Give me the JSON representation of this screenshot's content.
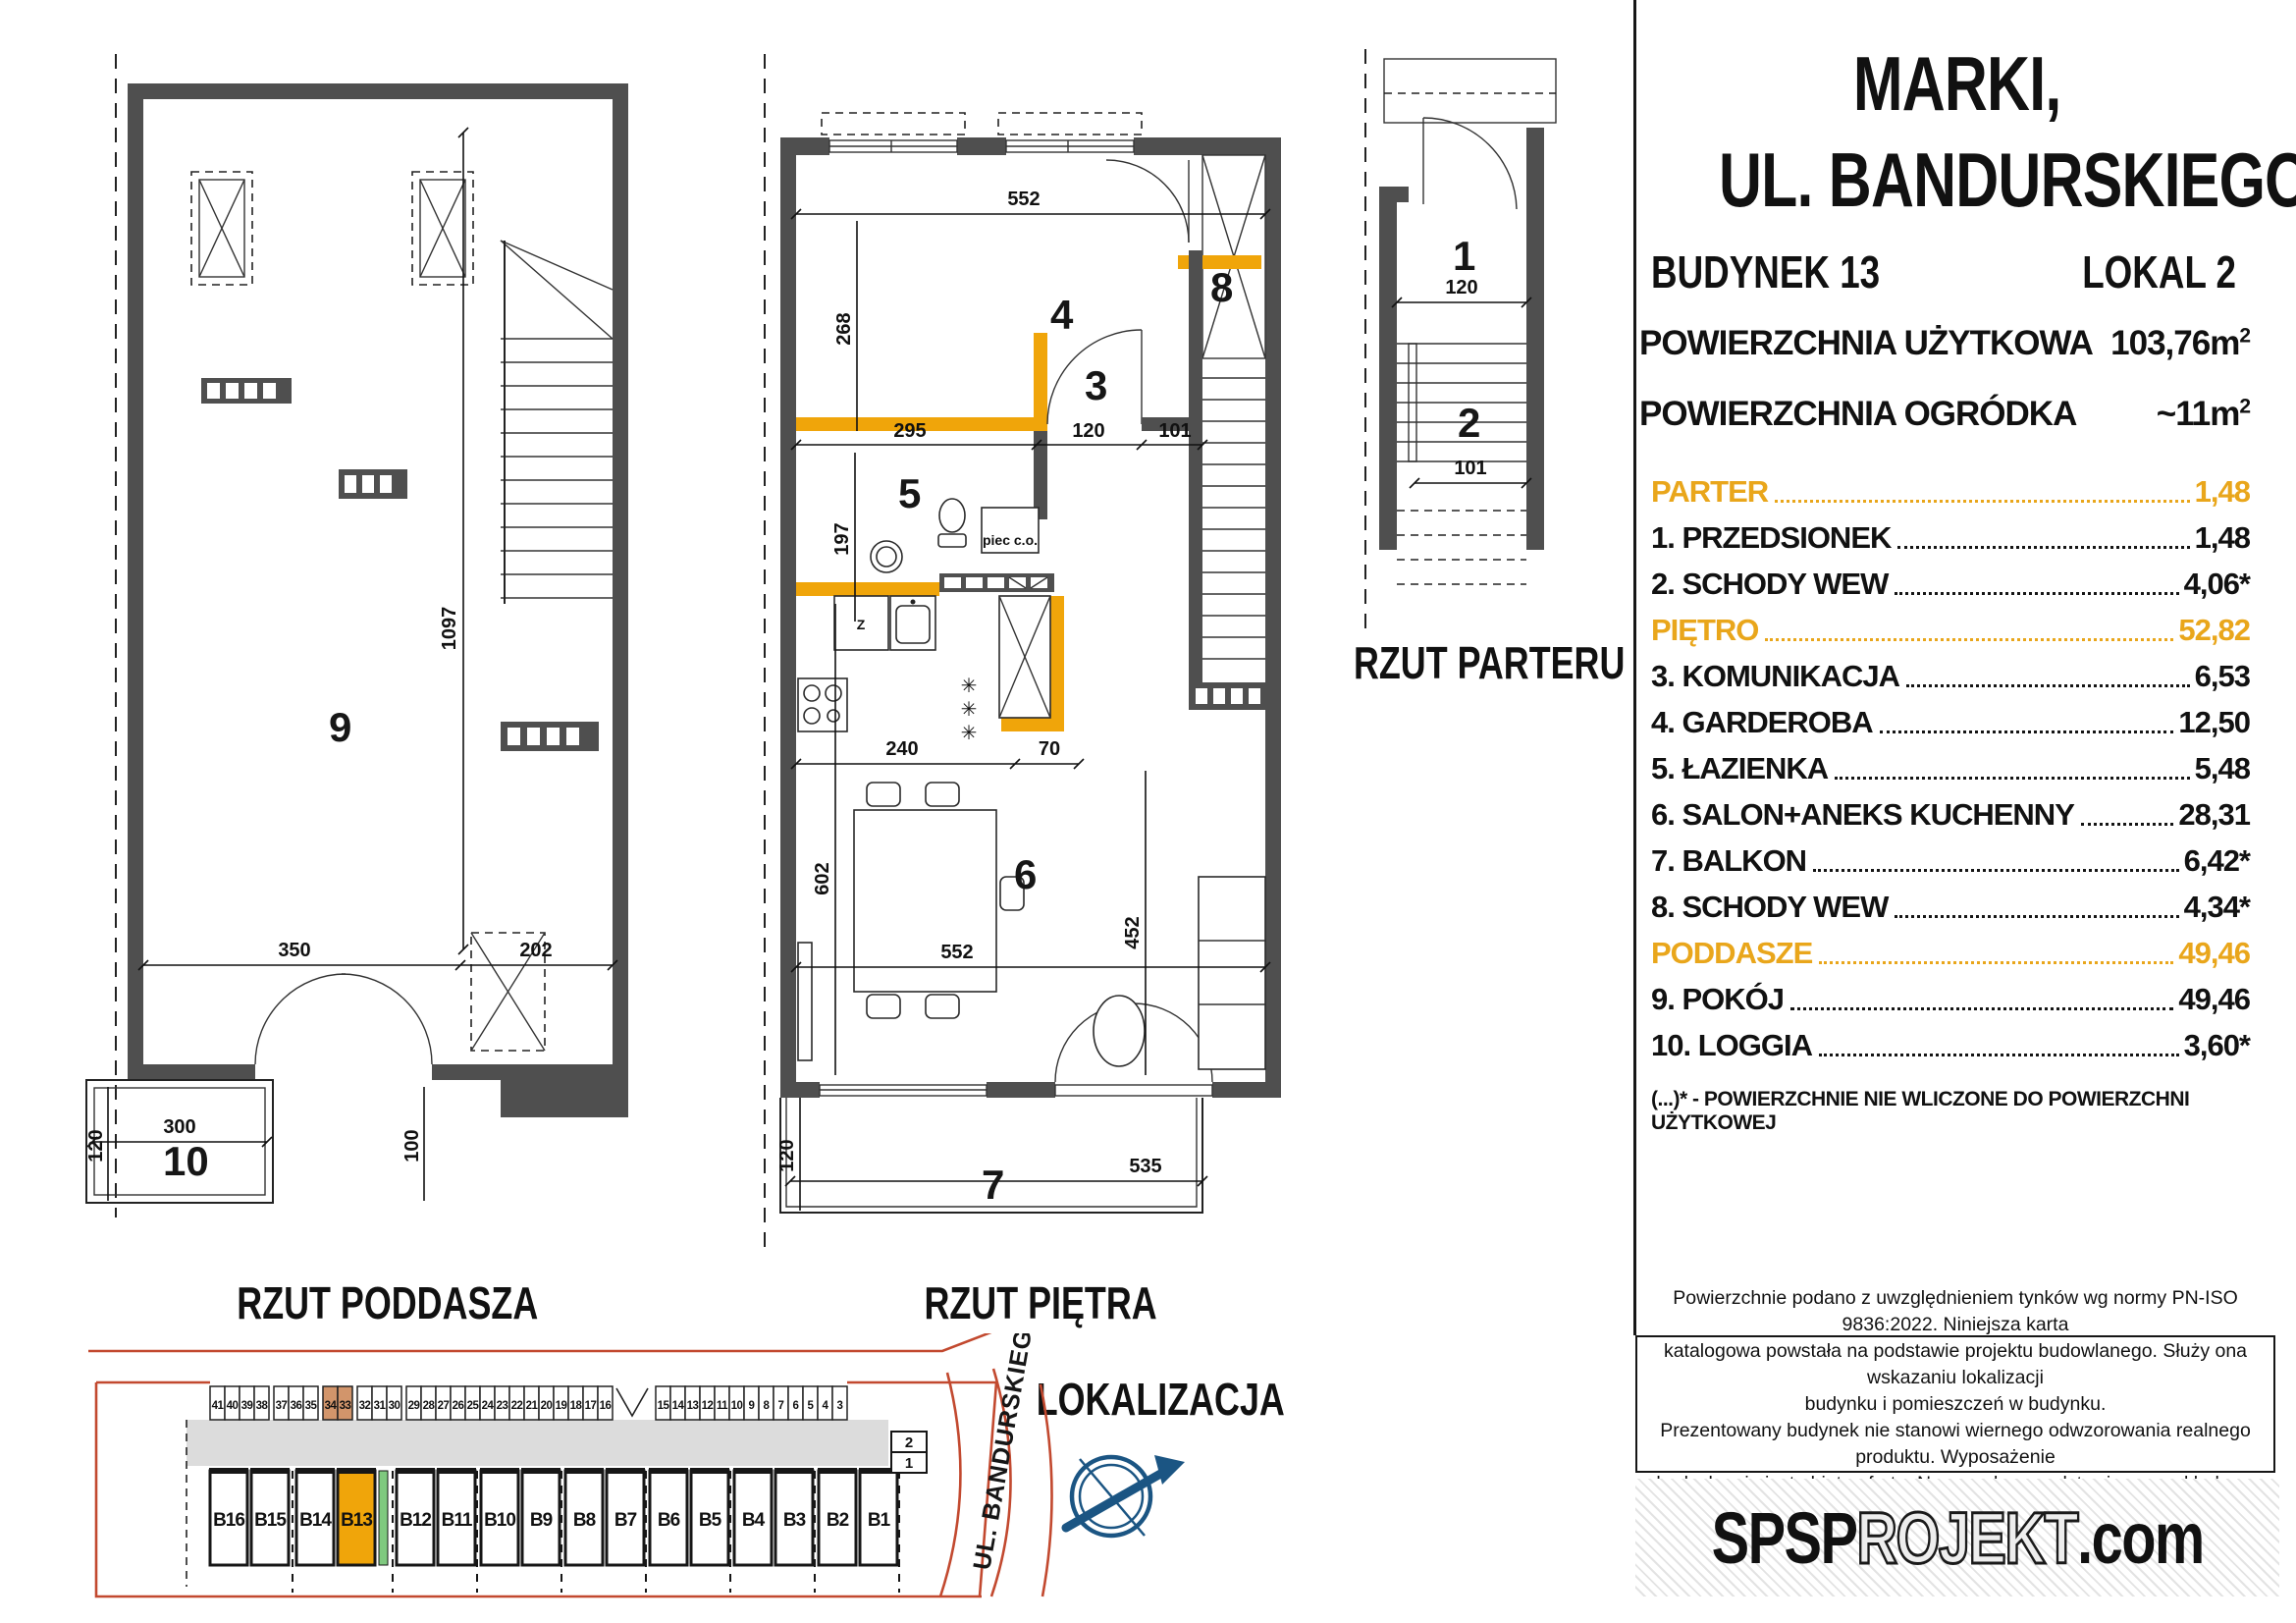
{
  "header": {
    "city_line": "MARKI,",
    "street_line": "UL. BANDURSKIEGO"
  },
  "banner": {
    "building": "BUDYNEK 13",
    "unit": "LOKAL 2"
  },
  "areas": {
    "usable_label": "POWIERZCHNIA UŻYTKOWA",
    "usable_value": "103,76m",
    "garden_label": "POWIERZCHNIA OGRÓDKA",
    "garden_value": "~11m",
    "sup": "2"
  },
  "rooms": [
    {
      "label": "PARTER",
      "value": "1,48",
      "section": true
    },
    {
      "label": "1. PRZEDSIONEK",
      "value": "1,48"
    },
    {
      "label": "2. SCHODY WEW",
      "value": "4,06*"
    },
    {
      "label": "PIĘTRO",
      "value": "52,82",
      "section": true
    },
    {
      "label": "3. KOMUNIKACJA",
      "value": "6,53"
    },
    {
      "label": "4. GARDEROBA",
      "value": "12,50"
    },
    {
      "label": "5. ŁAZIENKA",
      "value": "5,48"
    },
    {
      "label": "6. SALON+ANEKS KUCHENNY",
      "value": "28,31"
    },
    {
      "label": "7. BALKON",
      "value": "6,42*"
    },
    {
      "label": "8. SCHODY WEW",
      "value": "4,34*"
    },
    {
      "label": "PODDASZE",
      "value": "49,46",
      "section": true
    },
    {
      "label": "9. POKÓJ",
      "value": "49,46"
    },
    {
      "label": "10. LOGGIA",
      "value": "3,60*"
    }
  ],
  "footnote": "(...)* - POWIERZCHNIE  NIE WLICZONE DO POWIERZCHNI UŻYTKOWEJ",
  "plans": {
    "poddasze": {
      "title": "RZUT PODDASZA",
      "room9": "9",
      "room10": "10",
      "dims": {
        "h1097": "1097",
        "w350": "350",
        "w202": "202",
        "w300": "300",
        "h120": "120",
        "h100": "100"
      }
    },
    "pietro": {
      "title": "RZUT PIĘTRA",
      "room3": "3",
      "room4": "4",
      "room5": "5",
      "room6": "6",
      "room7": "7",
      "room8": "8",
      "boiler": "piec c.o.",
      "appliance": "Z",
      "dims": {
        "w552_top": "552",
        "h268": "268",
        "w295": "295",
        "w120": "120",
        "w101": "101",
        "h197": "197",
        "w240": "240",
        "w70": "70",
        "h602": "602",
        "h452": "452",
        "w552_bottom": "552",
        "w535": "535",
        "h120_bottom": "120"
      }
    },
    "parter": {
      "title": "RZUT PARTERU",
      "room1": "1",
      "room2": "2",
      "dims": {
        "w120": "120",
        "w101": "101"
      }
    }
  },
  "location": {
    "title": "LOKALIZACJA",
    "street": "UL. BANDURSKIEGO",
    "parking_groups": [
      {
        "numbers": [
          "41",
          "40",
          "39",
          "38"
        ],
        "highlight": false
      },
      {
        "numbers": [
          "37",
          "36",
          "35"
        ],
        "highlight": false
      },
      {
        "numbers": [
          "34",
          "33"
        ],
        "highlight": true
      },
      {
        "numbers": [
          "32",
          "31",
          "30"
        ],
        "highlight": false
      },
      {
        "numbers": [
          "29",
          "28",
          "27",
          "26",
          "25",
          "24",
          "23",
          "22",
          "21",
          "20",
          "19",
          "18",
          "17",
          "16"
        ],
        "highlight": false
      },
      {
        "numbers": [
          "15",
          "14",
          "13",
          "12",
          "11",
          "10",
          "9",
          "8",
          "7",
          "6",
          "5",
          "4",
          "3"
        ],
        "highlight": false
      }
    ],
    "buildings": [
      {
        "label": "B16"
      },
      {
        "label": "B15"
      },
      {
        "label": "B14"
      },
      {
        "label": "B13",
        "highlight": true
      },
      {
        "label": "B12"
      },
      {
        "label": "B11"
      },
      {
        "label": "B10"
      },
      {
        "label": "B9"
      },
      {
        "label": "B8"
      },
      {
        "label": "B7"
      },
      {
        "label": "B6"
      },
      {
        "label": "B5"
      },
      {
        "label": "B4"
      },
      {
        "label": "B3"
      },
      {
        "label": "B2"
      },
      {
        "label": "B1"
      }
    ],
    "side_units": [
      "2",
      "1"
    ]
  },
  "disclaimer": "Powierzchnie podano z uwzględnieniem tynków wg normy PN-ISO 9836:2022. Niniejsza karta\nkatalogowa powstała na podstawie projektu budowlanego. Służy ona wskazaniu lokalizacji\nbudynku i pomieszczeń w budynku.\nPrezentowany budynek nie stanowi wiernego odwzorowania realnego produktu. Wyposażenie\nbudynku nie jest objęte ofertą. Na rysunku przedstawiono przykładowe umeblowanie.",
  "logo": {
    "bold": "SPSP",
    "outline": "ROJEKT",
    "suffix": ".com"
  },
  "colors": {
    "accent_orange": "#F0A50A",
    "wall_gray": "#4F4F4F",
    "site_red": "#C2492F",
    "compass_blue": "#1B5583",
    "parking_highlight": "#D2956B",
    "green_strip": "#7FC97F"
  }
}
